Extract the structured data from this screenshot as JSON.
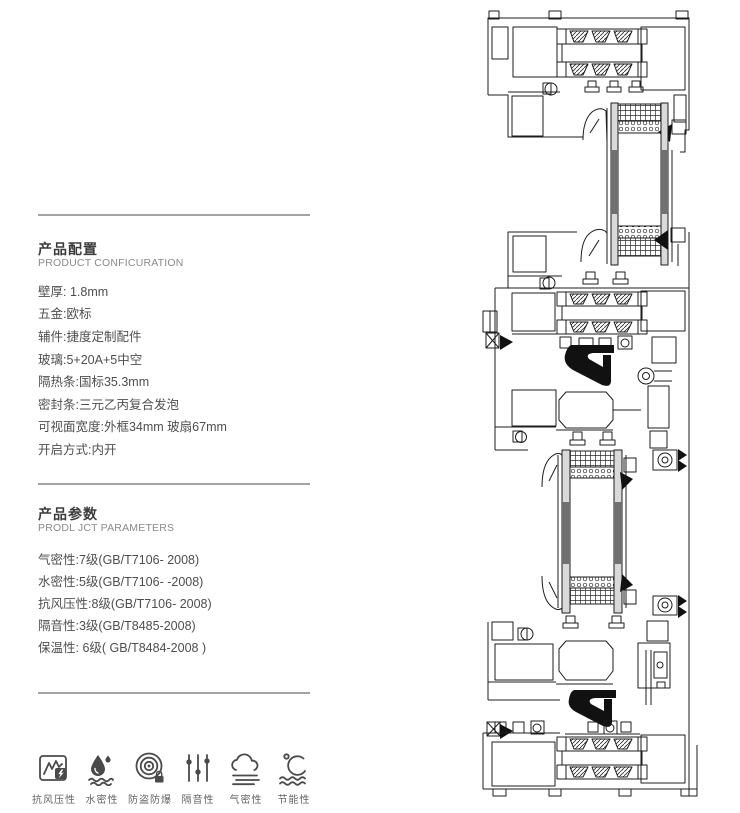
{
  "product_config": {
    "title": "产品配置",
    "subtitle": "PRODUCT CONFICURATION",
    "items": [
      "壁厚: 1.8mm",
      "五金:欧标",
      "辅件:捷度定制配件",
      "玻璃:5+20A+5中空",
      "隔热条:国标35.3mm",
      "密封条:三元乙丙复合发泡",
      "可视面宽度:外框34mm 玻扇67mm",
      "开启方式:内开"
    ]
  },
  "product_params": {
    "title": "产品参数",
    "subtitle": "PRODL JCT PARAMETERS",
    "items": [
      "气密性:7级(GB/T7106- 2008)",
      "水密性:5级(GB/T7106- -2008)",
      "抗风压性:8级(GB/T7106- 2008)",
      "隔音性:3级(GB/T8485-2008)",
      "保温性: 6级( GB/T8484-2008 )"
    ]
  },
  "feature_icons": [
    {
      "label": "抗风压性",
      "icon": "wind-pressure-icon"
    },
    {
      "label": "水密性",
      "icon": "water-tightness-icon"
    },
    {
      "label": "防盗防爆",
      "icon": "anti-theft-icon"
    },
    {
      "label": "隔音性",
      "icon": "sound-insulation-icon"
    },
    {
      "label": "气密性",
      "icon": "air-tightness-icon"
    },
    {
      "label": "节能性",
      "icon": "energy-saving-icon"
    }
  ],
  "drawing": {
    "description": "窗型材剖面图",
    "line_color": "#1c1c1c",
    "gasket_color": "#111111",
    "glass_color": "#d9d9d9",
    "glass_dark_color": "#707070"
  },
  "colors": {
    "rule": "#a3a3a3",
    "title_text": "#3c3c3c",
    "subtitle_text": "#8a8a8a",
    "body_text": "#4e4e4e",
    "icon_stroke": "#4a4a4a",
    "background": "#ffffff"
  }
}
